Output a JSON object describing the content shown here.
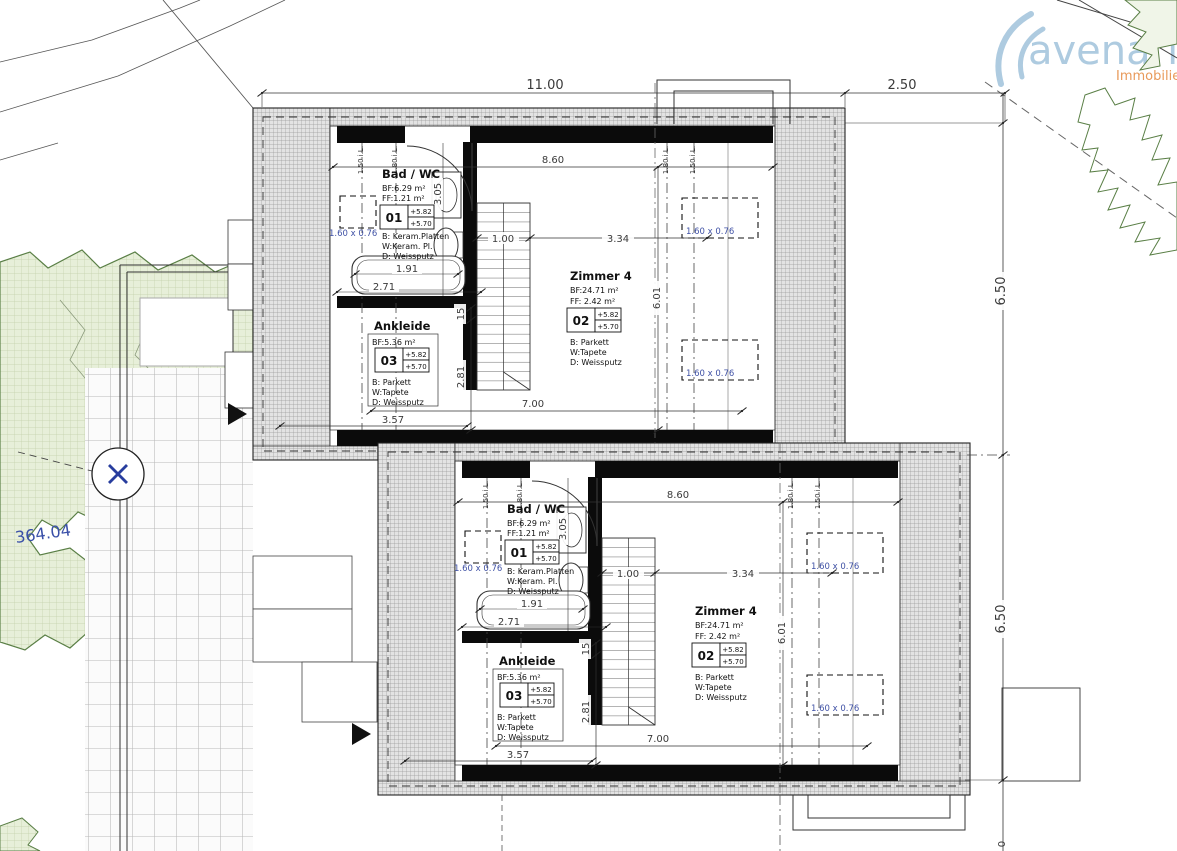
{
  "logo": {
    "brand": "avenaris",
    "subtitle": "Immobilien"
  },
  "site": {
    "spot_elevation": "364.04"
  },
  "dims": {
    "overall_width": "11.00",
    "side_offset": "2.50",
    "depth_upper": "6.50",
    "depth_lower": "6.50",
    "cut_bottom": "0"
  },
  "unit": {
    "dims": {
      "interior_width": "8.60",
      "stair_width": "1.00",
      "zimmer_width": "3.34",
      "zimmer_depth": "6.01",
      "tub_length": "1.91",
      "bad_width": "2.71",
      "wall_thickness": "15",
      "ankleide_depth": "2.81",
      "bottom_width": "7.00",
      "bottom_partial": "3.57",
      "bad_depth": "3.05",
      "skylight_size": "1.60 x 0.76",
      "roofline_150": "1.50 i.L.",
      "roofline_180": "1.80 i.L."
    },
    "rooms": {
      "bad": {
        "name": "Bad / WC",
        "area": "BF:6.29 m²",
        "area2": "FF:1.21 m²",
        "tag": "01",
        "level_top": "+5.82",
        "level_bottom": "+5.70",
        "floor": "B: Keram.Platten",
        "walls": "W:Keram. Pl.",
        "ceiling": "D: Weissputz"
      },
      "zimmer": {
        "name": "Zimmer 4",
        "area": "BF:24.71 m²",
        "area2": "FF: 2.42 m²",
        "tag": "02",
        "level_top": "+5.82",
        "level_bottom": "+5.70",
        "floor": "B: Parkett",
        "walls": "W:Tapete",
        "ceiling": "D: Weissputz"
      },
      "ankleide": {
        "name": "Ankleide",
        "area": "BF:5.36 m²",
        "tag": "03",
        "level_top": "+5.82",
        "level_bottom": "+5.70",
        "floor": "B: Parkett",
        "walls": "W:Tapete",
        "ceiling": "D: Weissputz"
      }
    }
  }
}
